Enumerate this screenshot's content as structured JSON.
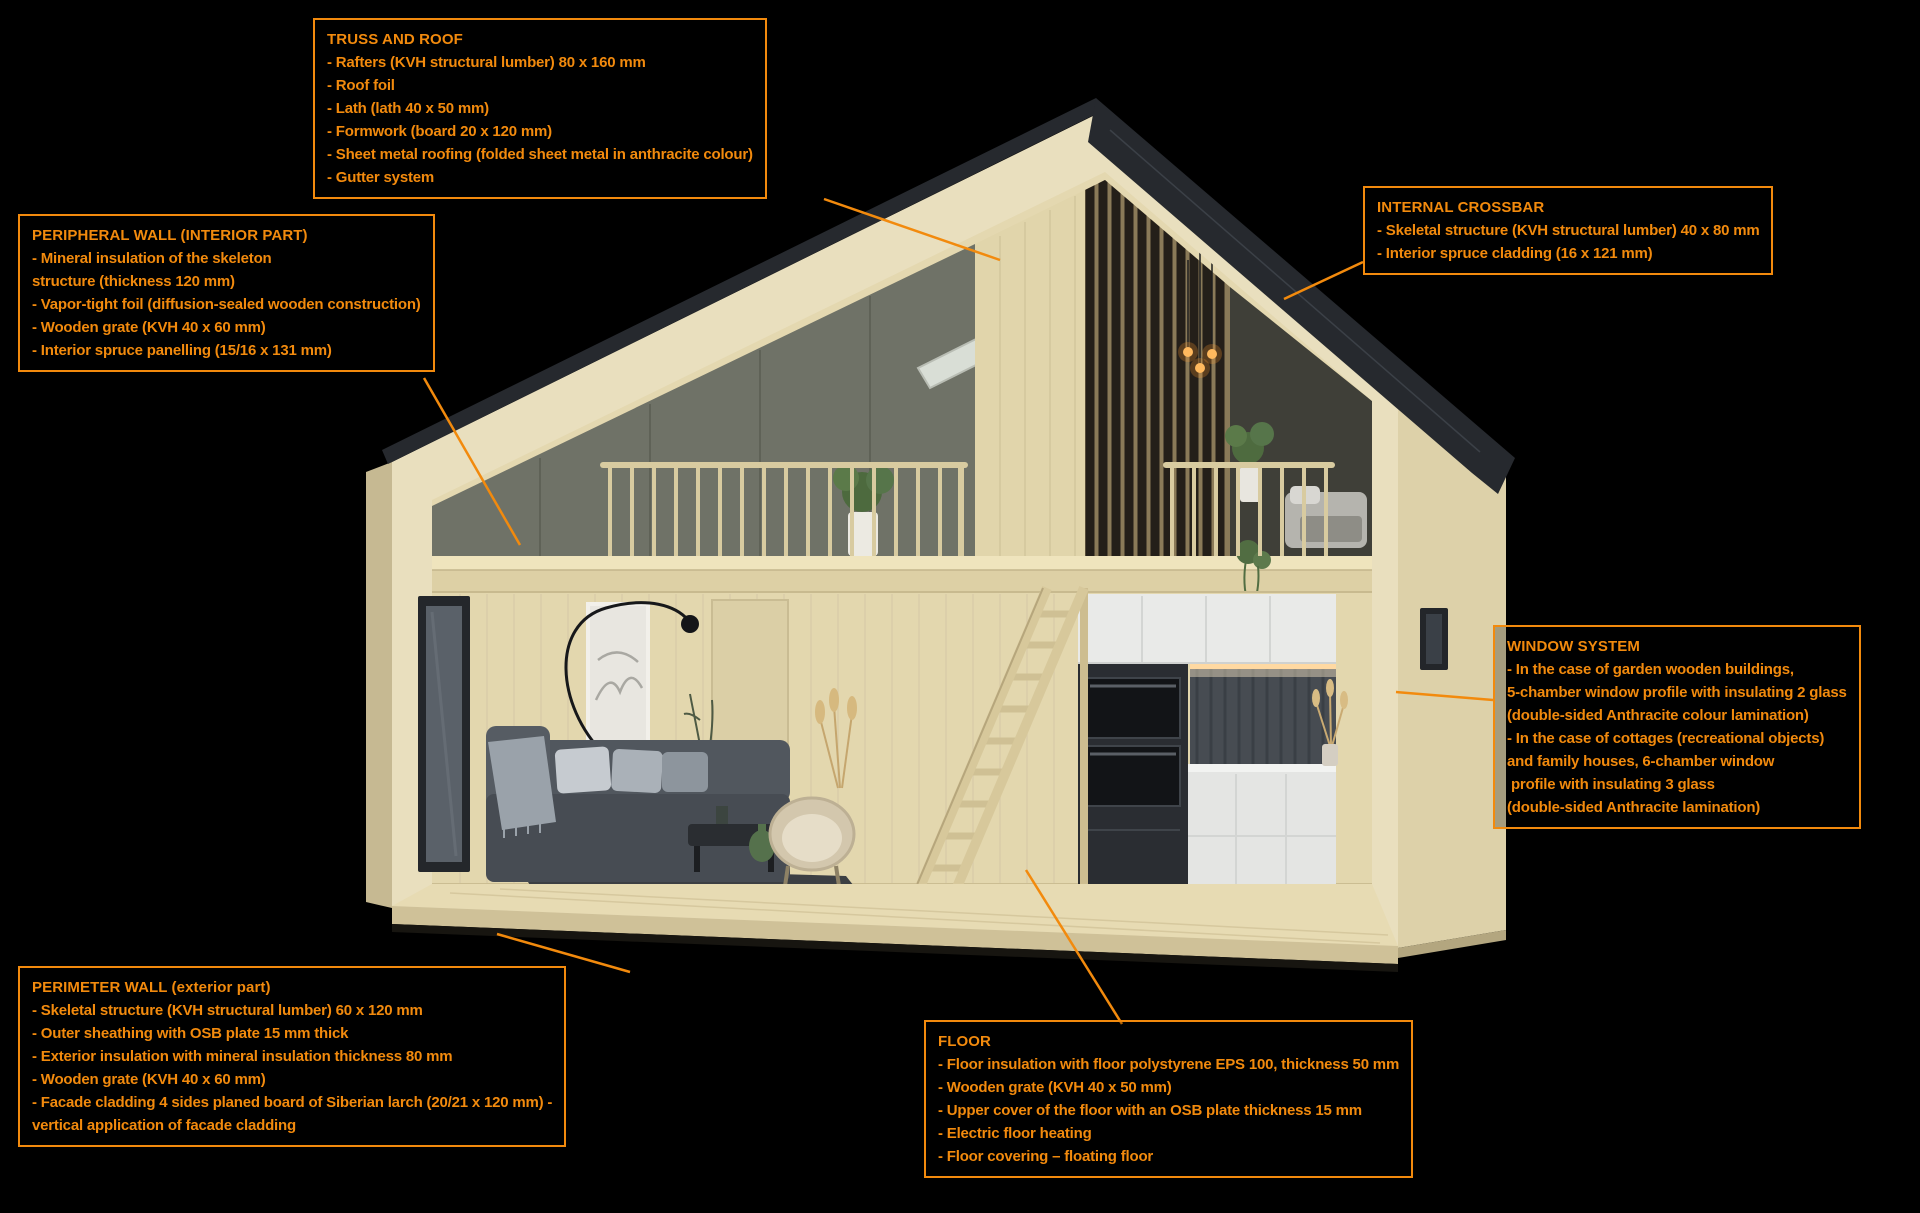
{
  "colors": {
    "background": "#000000",
    "accent": "#f28a0d",
    "roof_anthracite": "#26292e",
    "wood_light": "#e9dfbe",
    "wood_mid": "#e4d8b0",
    "wood_shadow": "#cdbf97"
  },
  "callouts": {
    "truss_roof": {
      "title": "TRUSS AND ROOF",
      "lines": [
        "- Rafters (KVH structural lumber) 80 x 160 mm",
        "- Roof foil",
        "- Lath (lath 40 x 50 mm)",
        "- Formwork (board 20 x 120 mm)",
        "- Sheet metal roofing (folded sheet metal in anthracite colour)",
        "- Gutter system"
      ]
    },
    "peripheral_wall": {
      "title": "PERIPHERAL WALL (INTERIOR PART)",
      "lines": [
        "- Mineral insulation of the skeleton",
        "structure (thickness 120 mm)",
        "- Vapor-tight foil (diffusion-sealed wooden construction)",
        "- Wooden grate (KVH 40 x 60 mm)",
        "- Interior spruce panelling (15/16 x 131 mm)"
      ]
    },
    "internal_crossbar": {
      "title": "INTERNAL CROSSBAR",
      "lines": [
        "- Skeletal structure (KVH structural lumber) 40 x 80 mm",
        "- Interior spruce cladding (16 x 121 mm)"
      ]
    },
    "window_system": {
      "title": "WINDOW SYSTEM",
      "lines": [
        "- In the case of garden wooden buildings,",
        "5-chamber window profile with insulating 2 glass",
        "(double-sided Anthracite colour lamination)",
        "- In the case of cottages (recreational objects)",
        "and family houses, 6-chamber window",
        " profile with insulating 3 glass",
        "(double-sided Anthracite lamination)"
      ]
    },
    "perimeter_wall": {
      "title": "PERIMETER WALL (exterior part)",
      "lines": [
        "- Skeletal structure (KVH structural lumber) 60 x 120 mm",
        "- Outer sheathing with OSB plate 15 mm thick",
        "- Exterior insulation with mineral insulation thickness 80 mm",
        "- Wooden grate (KVH 40 x 60 mm)",
        "- Facade cladding 4 sides planed board of Siberian larch (20/21 x 120 mm) -",
        "vertical application of facade cladding"
      ]
    },
    "floor": {
      "title": "FLOOR",
      "lines": [
        "- Floor insulation with floor polystyrene EPS 100, thickness 50 mm",
        "- Wooden grate (KVH 40 x 50 mm)",
        "- Upper cover of the floor with an OSB plate thickness 15 mm",
        "- Electric floor heating",
        "- Floor covering – floating floor"
      ]
    }
  }
}
